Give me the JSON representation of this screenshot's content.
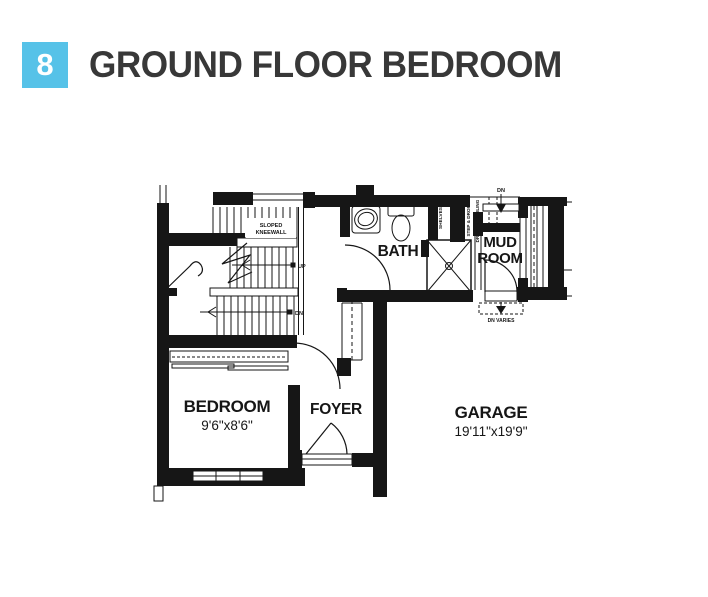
{
  "header": {
    "badge_number": "8",
    "title": "GROUND FLOOR BEDROOM"
  },
  "colors": {
    "accent": "#56c2e8",
    "title_text": "#383838",
    "plan_ink": "#161616"
  },
  "floor_plan": {
    "rooms": {
      "bedroom": {
        "label": "BEDROOM",
        "dimensions": "9'6\"x8'6\""
      },
      "foyer": {
        "label": "FOYER"
      },
      "bath": {
        "label": "BATH"
      },
      "mud_room": {
        "label_line1": "MUD",
        "label_line2": "ROOM"
      },
      "garage": {
        "label": "GARAGE",
        "dimensions": "19'11\"x19'9\""
      }
    },
    "annotations": {
      "sloped_kneewall_line1": "SLOPED",
      "sloped_kneewall_line2": "KNEEWALL",
      "up": "UP",
      "dn_stairs": "DN",
      "dn_landing": "DN",
      "dn_varies": "DN VARIES",
      "shelves": "SHELVES",
      "step_and_drop": "STEP & DROP",
      "dropped_ceiling": "DROPPED CEILING"
    }
  }
}
